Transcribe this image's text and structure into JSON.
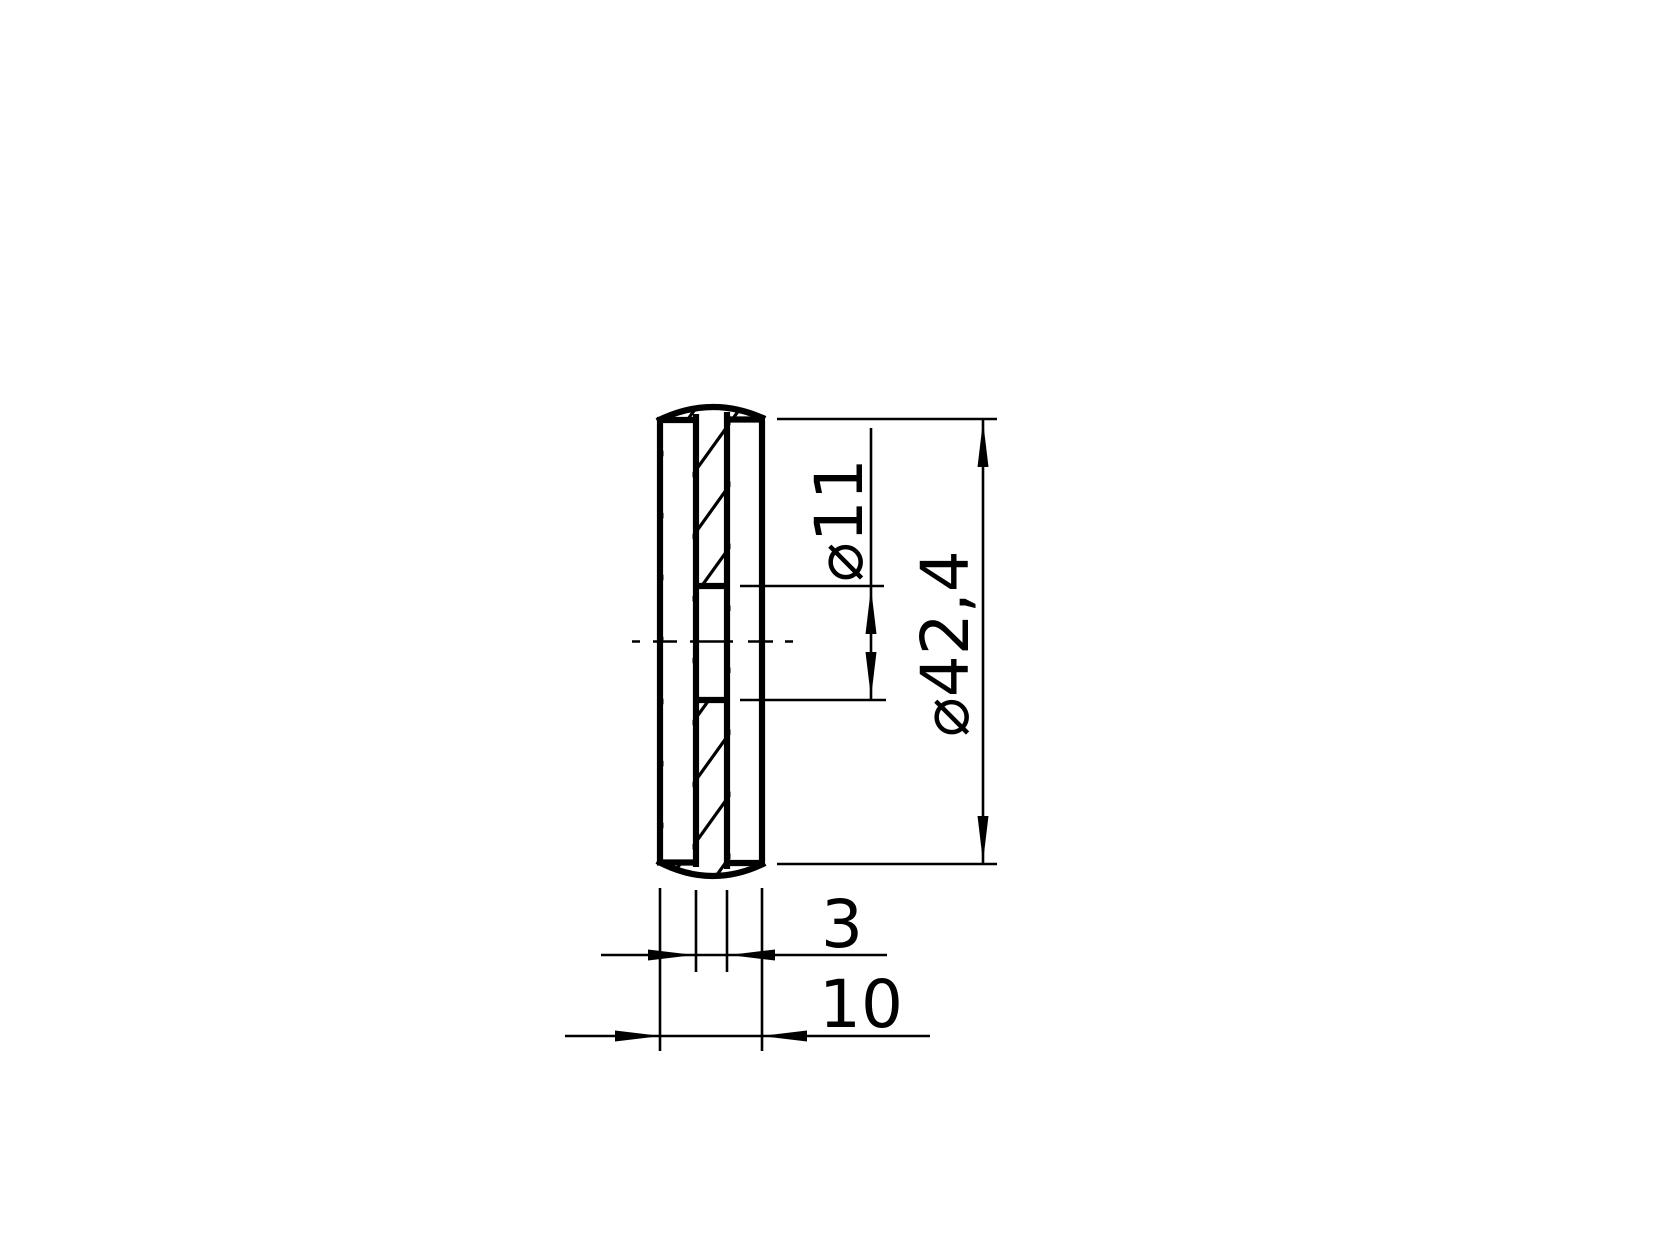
{
  "drawing": {
    "kind": "technical-section-drawing",
    "dimensions": {
      "hole_diameter_label": "⌀11",
      "outer_diameter_label": "⌀42,4",
      "wall_thickness_label": "3",
      "overall_thickness_label": "10"
    },
    "colors": {
      "line": "#000000",
      "background": "#ffffff"
    }
  }
}
